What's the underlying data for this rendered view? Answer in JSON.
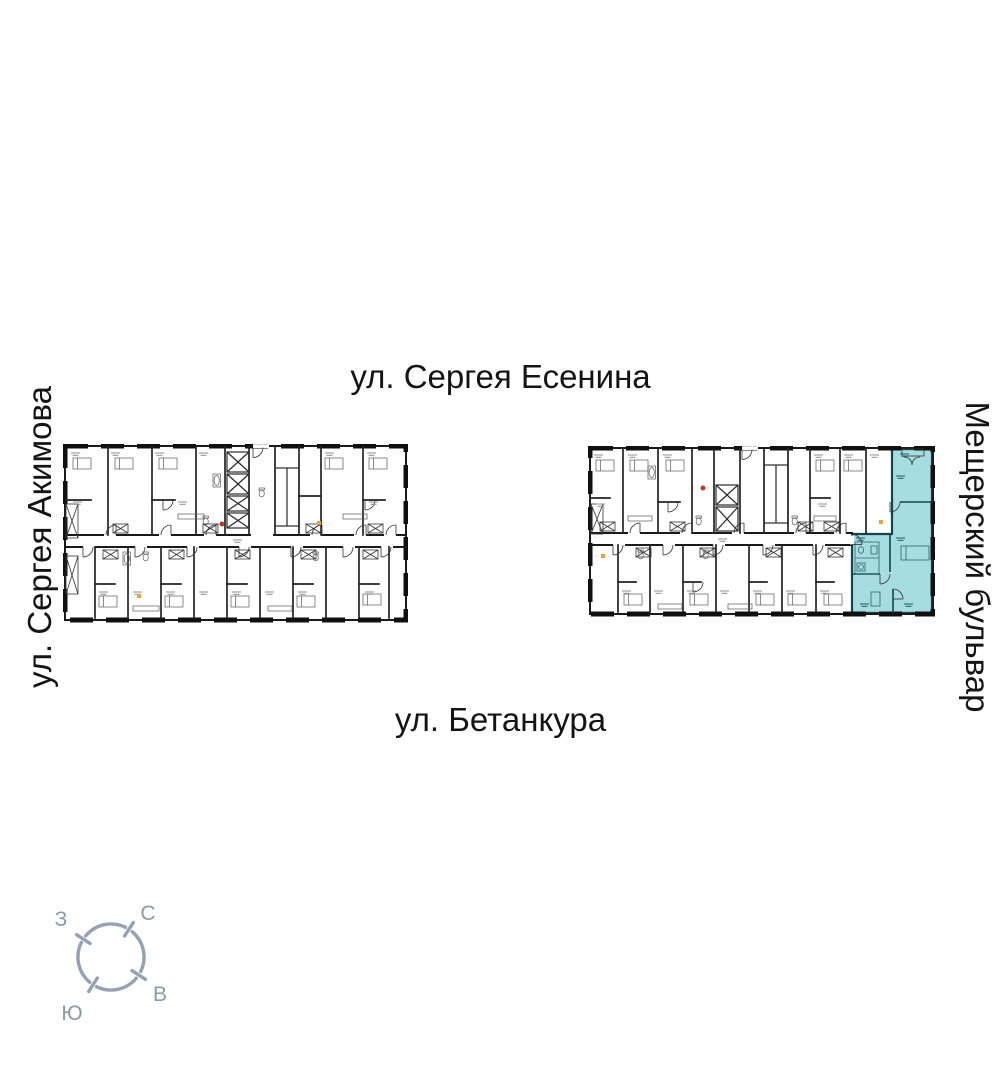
{
  "canvas": {
    "width": 1001,
    "height": 1068,
    "background": "#ffffff"
  },
  "streets": {
    "top": {
      "label": "ул. Сергея Есенина"
    },
    "bottom": {
      "label": "ул. Бетанкура"
    },
    "left": {
      "label": "ул. Сергея Акимова"
    },
    "right": {
      "label": "Мещерский бульвар"
    }
  },
  "compass": {
    "north": "С",
    "west": "З",
    "south": "Ю",
    "east": "В"
  },
  "colors": {
    "highlight_fill": "#a7dce0",
    "highlight_line": "#12454d",
    "plan_line": "#1a1a1a",
    "compass": "#96a2b2",
    "street_text": "#141414",
    "accent_orange": "#e8a33d",
    "accent_red": "#c0392b"
  }
}
